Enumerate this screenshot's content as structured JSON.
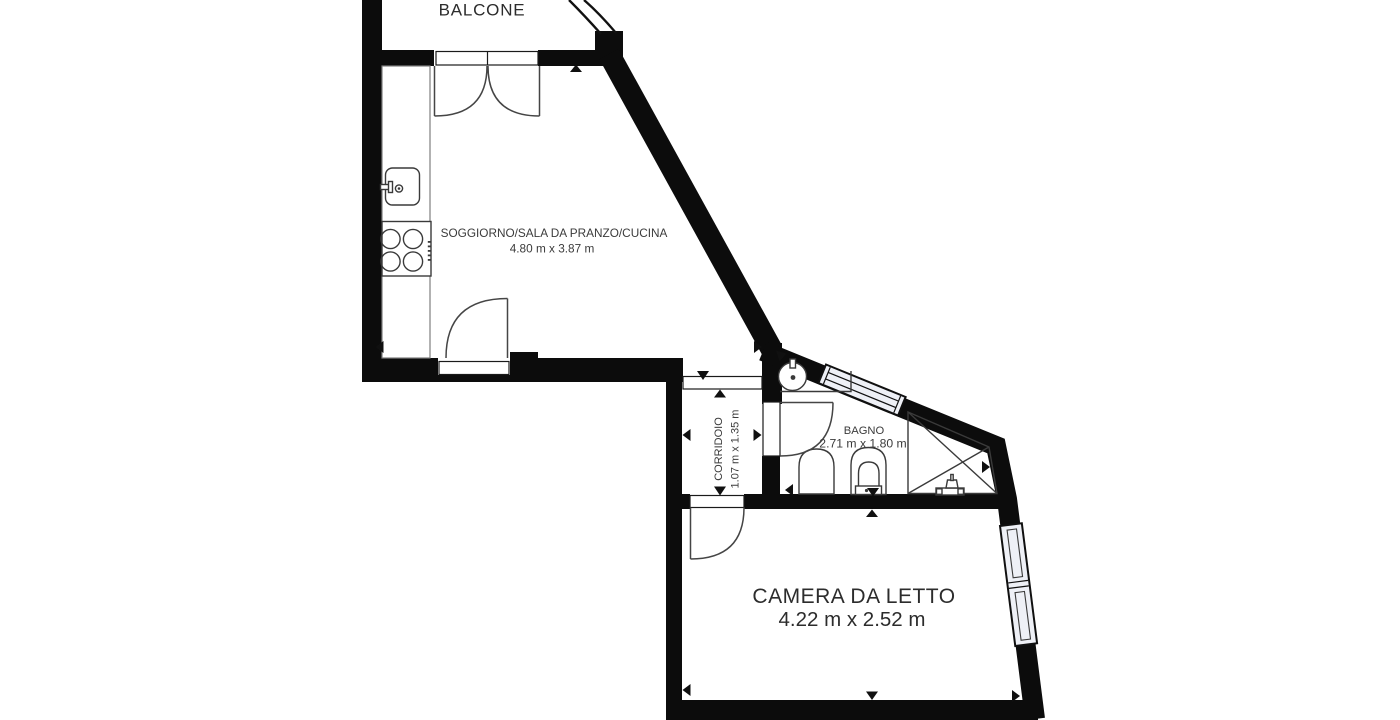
{
  "title": "Floor Plan",
  "rooms": {
    "balcone": {
      "label": "BALCONE"
    },
    "soggiorno": {
      "label": "SOGGIORNO/SALA DA PRANZO/CUCINA",
      "dims": "4.80 m x 3.87 m"
    },
    "corridoio": {
      "label": "CORRIDOIO",
      "dims": "1.07 m x 1.35 m"
    },
    "bagno": {
      "label": "BAGNO",
      "dims": "2.71 m x 1.80 m"
    },
    "camera": {
      "label": "CAMERA DA LETTO",
      "dims": "4.22 m x 2.52 m"
    }
  },
  "fixtures": [
    "kitchen-sink-icon",
    "cooktop-icon",
    "washbasin-icon",
    "bidet-icon",
    "toilet-icon",
    "shower-icon",
    "shower-mixer-icon",
    "window-icon",
    "door-swing-icon",
    "dimension-arrow-icon",
    "balcony-railing-icon"
  ],
  "colors": {
    "wall": "#0c0c0c",
    "fixline": "#3a3a3a",
    "label": "#3b3b3b",
    "label_dark": "#2c2c2c",
    "glass": "#eef0f6",
    "bg": "#ffffff",
    "counter": "#7e7e7e",
    "door": "#454545"
  }
}
